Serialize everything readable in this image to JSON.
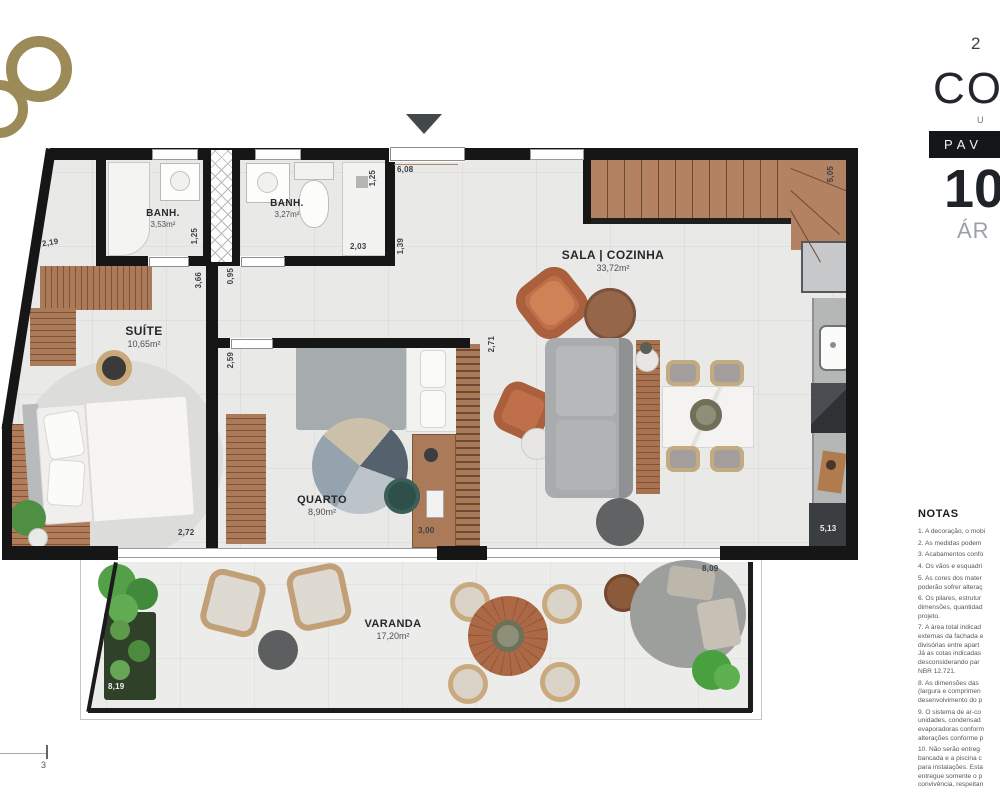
{
  "side_panel": {
    "unit": "2",
    "title": "COB",
    "subtitle": "U",
    "banner": "PAV",
    "big_number": "10",
    "area_label": "ÁR",
    "notas_title": "NOTAS",
    "notes": [
      "1. A decoração, o mobi",
      "2. As medidas podem",
      "3. Acabamentos confo",
      "4. Os vãos e esquadri",
      "5. As cores dos mater",
      "poderão sofrer alteraç",
      "6. Os pilares, estrutur",
      "dimensões, quantidad",
      "projeto.",
      "7. A área total indicad",
      "externas da fachada e",
      "divisórias entre apart",
      "Já as cotas indicadas",
      "desconsiderando par",
      "NBR 12.721.",
      "8. As dimensões das",
      "(largura e comprimen",
      "desenvolvimento do p",
      "9. O sistema de ar-co",
      "unidades, condensad",
      "evaporadoras conform",
      "alterações conforme p",
      "10. Não serão entreg",
      "bancada e a piscina c",
      "para instalações. Esta",
      "entregue somente o p",
      "convivência, respeitan"
    ]
  },
  "rooms": {
    "banh1": {
      "name": "BANH.",
      "area": "3,53m²"
    },
    "banh2": {
      "name": "BANH.",
      "area": "3,27m²"
    },
    "suite": {
      "name": "SUÍTE",
      "area": "10,65m²"
    },
    "quarto": {
      "name": "QUARTO",
      "area": "8,90m²"
    },
    "sala": {
      "name": "SALA | COZINHA",
      "area": "33,72m²"
    },
    "varanda": {
      "name": "VARANDA",
      "area": "17,20m²"
    }
  },
  "dims": {
    "d219": "2,19",
    "d125a": "1,25",
    "d125b": "1,25",
    "d203": "2,03",
    "d608": "6,08",
    "d139": "1,39",
    "d366": "3,66",
    "d095": "0,95",
    "d259": "2,59",
    "d271": "2,71",
    "d272": "2,72",
    "d300": "3,00",
    "d505": "5,05",
    "d513": "5,13",
    "d809": "8,09",
    "d819": "8,19"
  },
  "footer": {
    "scale_label": "3"
  },
  "colors": {
    "logo_gold": "#9c8a58",
    "banner_bg": "#141619",
    "wall": "#161616"
  }
}
